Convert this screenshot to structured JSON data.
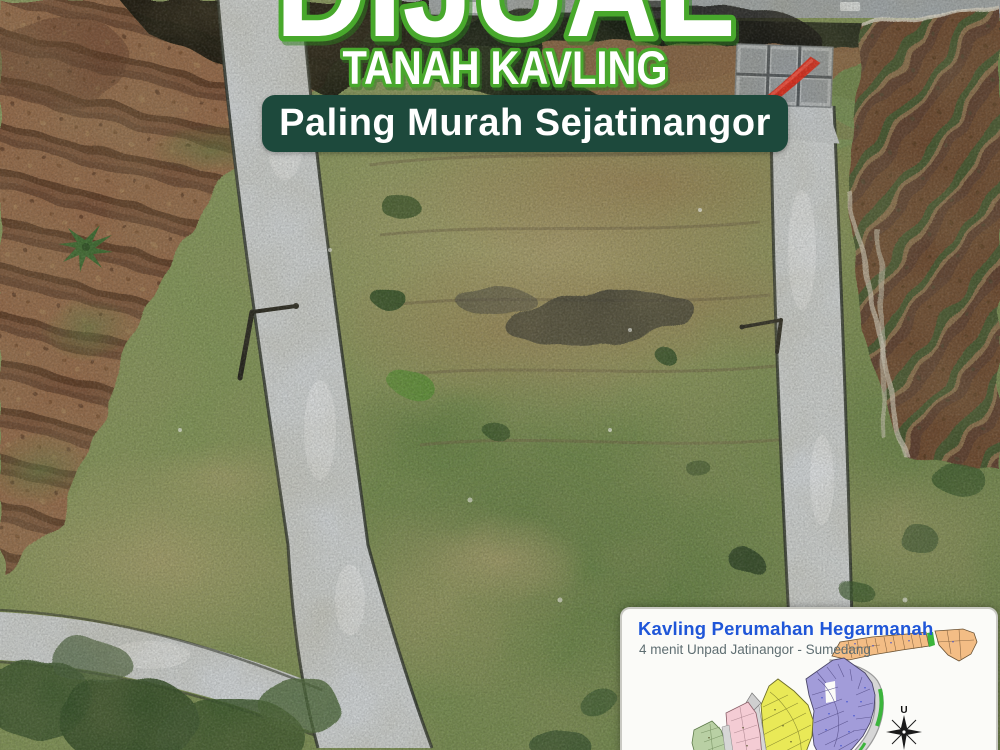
{
  "poster": {
    "title": "DIJUAL",
    "subtitle": "TANAH KAVLING",
    "banner_text": "Paling Murah Sejatinangor"
  },
  "inset_map": {
    "title": "Kavling Perumahan Hegarmanah",
    "subtitle": "4 menit Unpad Jatinangor - Sumedang",
    "compass_label": "U"
  },
  "colors": {
    "outline_green": "#48a82c",
    "banner_background": "#1d493c",
    "banner_text": "#ffffff",
    "map_title_blue": "#1f56d8",
    "map_subtitle_gray": "#5f6e72",
    "plot_orange": "#f3bd85",
    "plot_purple": "#a29cd9",
    "plot_yellow": "#e9e957",
    "plot_pink": "#f4ccd4",
    "plot_green": "#b9d0a4",
    "map_road_gray": "#d6d6d6",
    "map_green_strip": "#3cb53c",
    "road_concrete": "#ccd0d1"
  }
}
